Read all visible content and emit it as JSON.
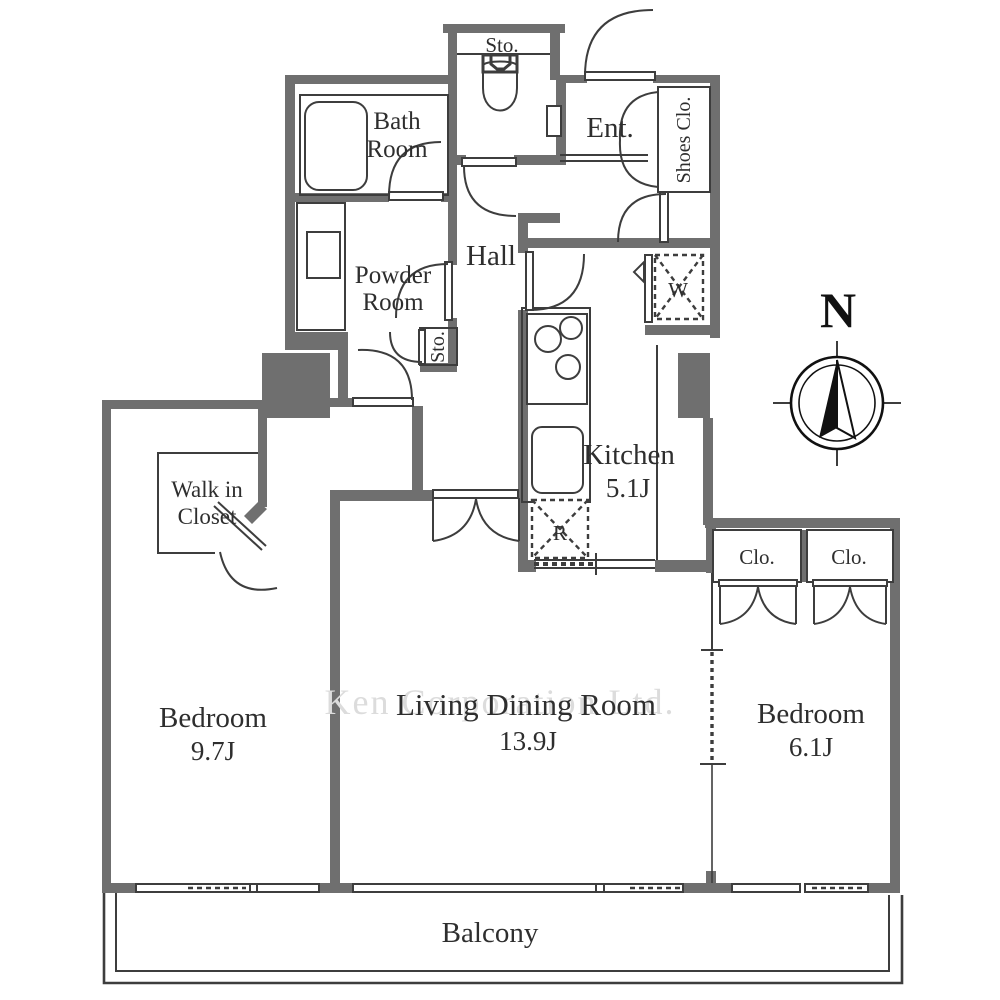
{
  "rooms": {
    "storage_top": "Sto.",
    "bath_1": "Bath",
    "bath_2": "Room",
    "entrance": "Ent.",
    "shoes_closet": "Shoes Clo.",
    "powder_1": "Powder",
    "powder_2": "Room",
    "hall": "Hall",
    "washing_machine": "W",
    "storage_hall": "Sto.",
    "kitchen_name": "Kitchen",
    "kitchen_size": "5.1J",
    "refrigerator": "R",
    "wic_1": "Walk in",
    "wic_2": "Closet",
    "closet_left": "Clo.",
    "closet_right": "Clo.",
    "bedroom1_name": "Bedroom",
    "bedroom1_size": "9.7J",
    "ldr_name": "Living Dining Room",
    "ldr_size": "13.9J",
    "bedroom2_name": "Bedroom",
    "bedroom2_size": "6.1J",
    "balcony": "Balcony"
  },
  "compass": {
    "north_label": "N"
  },
  "watermark": "Ken Corporation Ltd.",
  "colors": {
    "wall": "#6f6f6f",
    "line": "#3d3d3d",
    "text": "#2e2e2e",
    "watermark": "#dcdcdc",
    "background": "#ffffff"
  }
}
